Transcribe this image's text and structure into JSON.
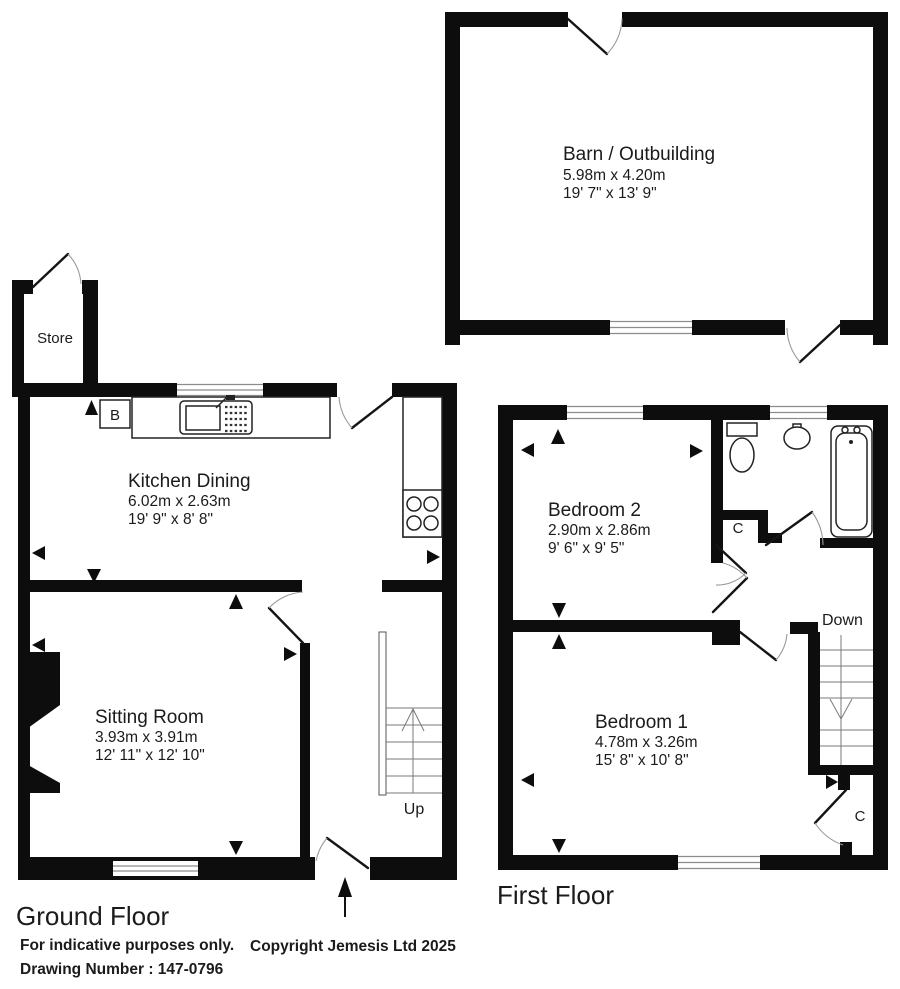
{
  "plan": {
    "ground_floor_title": "Ground Floor",
    "first_floor_title": "First Floor"
  },
  "rooms": {
    "barn": {
      "name": "Barn / Outbuilding",
      "metric": "5.98m x 4.20m",
      "imperial": "19' 7\" x 13' 9\""
    },
    "store": {
      "name": "Store"
    },
    "kitchen": {
      "name": "Kitchen Dining",
      "metric": "6.02m x 2.63m",
      "imperial": "19' 9\" x 8' 8\""
    },
    "sitting": {
      "name": "Sitting Room",
      "metric": "3.93m x 3.91m",
      "imperial": "12' 11\" x 12' 10\""
    },
    "bedroom2": {
      "name": "Bedroom 2",
      "metric": "2.90m x 2.86m",
      "imperial": "9' 6\" x 9' 5\""
    },
    "bedroom1": {
      "name": "Bedroom 1",
      "metric": "4.78m x 3.26m",
      "imperial": "15' 8\" x 10' 8\""
    }
  },
  "labels": {
    "up": "Up",
    "down": "Down",
    "boiler": "B",
    "cupboard": "C"
  },
  "footer": {
    "indicative": "For indicative purposes only.",
    "drawing_number": "Drawing Number : 147-0796",
    "copyright": "Copyright Jemesis Ltd 2025"
  },
  "colors": {
    "wall": "#0d0d0d",
    "background": "#ffffff"
  }
}
